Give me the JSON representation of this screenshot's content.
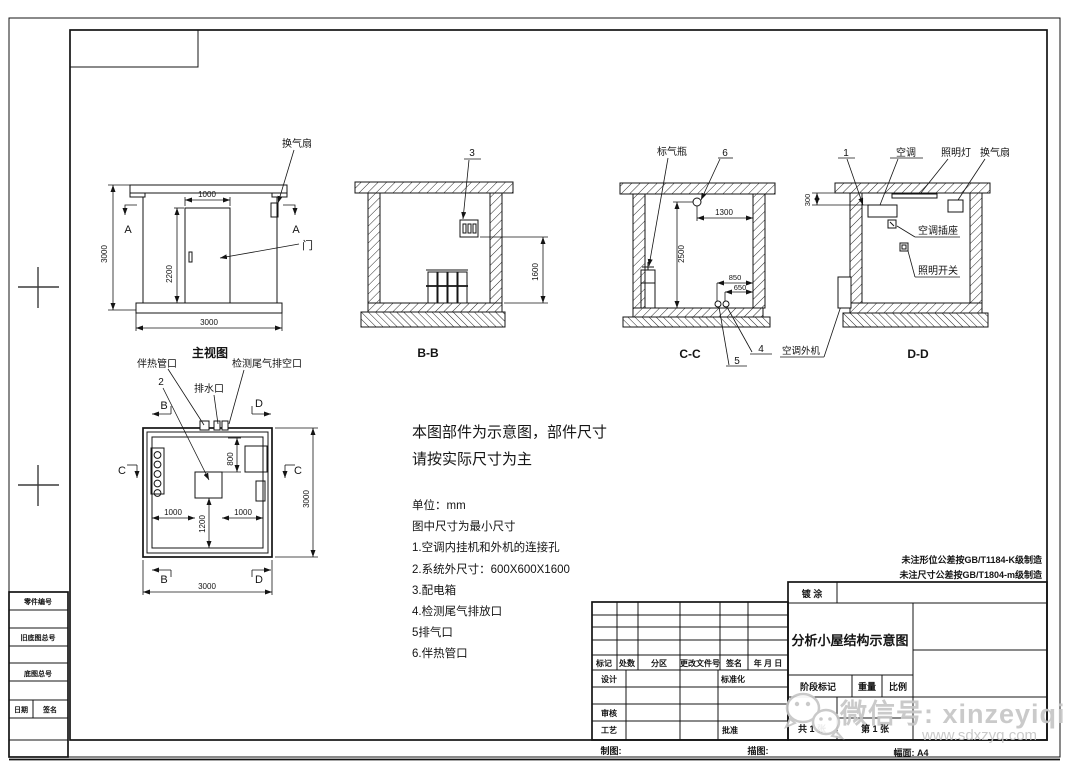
{
  "front_view": {
    "title": "主视图",
    "fan_label": "换气扇",
    "door_label": "门",
    "section_left": "A",
    "section_right": "A",
    "dim_height": "3000",
    "dim_door_width": "1000",
    "dim_door_height": "2200",
    "dim_width": "3000"
  },
  "section_bb": {
    "title": "B-B",
    "item3": "3",
    "dim_1600": "1600"
  },
  "section_cc": {
    "title": "C-C",
    "gas_bottle_label": "标气瓶",
    "item6": "6",
    "item5": "5",
    "item4": "4",
    "dim_1300": "1300",
    "dim_2500": "2500",
    "dim_850": "850",
    "dim_650": "650",
    "outdoor_unit_label": "空调外机"
  },
  "section_dd": {
    "title": "D-D",
    "item1": "1",
    "ac_label": "空调",
    "lamp_label": "照明灯",
    "fan_label": "换气扇",
    "socket_label": "空调插座",
    "switch_label": "照明开关",
    "dim_300": "300"
  },
  "plan_view": {
    "heat_pipe_label": "伴热管口",
    "item2": "2",
    "drain_label": "排水口",
    "exhaust_label": "检测尾气排空口",
    "sec_b_top": "B",
    "sec_b_bottom": "B",
    "sec_c_left": "C",
    "sec_c_right": "C",
    "sec_d_top": "D",
    "sec_d_bottom": "D",
    "dim_800": "800",
    "dim_1000_left": "1000",
    "dim_1200": "1200",
    "dim_1000_right": "1000",
    "dim_3000_right": "3000",
    "dim_3000_bottom": "3000"
  },
  "notes": {
    "headline1": "本图部件为示意图，部件尺寸",
    "headline2": "请按实际尺寸为主",
    "unit": "单位：mm",
    "min_size": "图中尺寸为最小尺寸",
    "item1": "1.空调内挂机和外机的连接孔",
    "item2": "2.系统外尺寸：600X600X1600",
    "item3": "3.配电箱",
    "item4": "4.检测尾气排放口",
    "item5": "5排气口",
    "item6": "6.伴热管口"
  },
  "tolerance_notes": {
    "line1": "未注形位公差按GB/T1184-K级制造",
    "line2": "未注尺寸公差按GB/T1804-m级制造"
  },
  "title_block": {
    "coating": "镀 涂",
    "drawing_title": "分析小屋结构示意图",
    "stage_mark": "阶段标记",
    "weight": "重量",
    "scale": "比例",
    "total_sheets": "共 1 张",
    "sheet_no": "第 1 张",
    "format": "幅面: A4",
    "draw_label": "制图:",
    "trace_label": "描图:"
  },
  "revision_table": {
    "headers": [
      "标记",
      "处数",
      "分区",
      "更改文件号",
      "签名",
      "年 月 日"
    ],
    "design": "设计",
    "standardization": "标准化",
    "review": "审核",
    "process": "工艺",
    "approve": "批准"
  },
  "side_block": {
    "part_no": "零件编号",
    "old_negative_no": "旧底图总号",
    "negative_no": "底图总号",
    "date": "日期",
    "signature": "签名"
  },
  "watermark": {
    "wechat_id": "微信号: xinzeyiqi",
    "website": "www.sdxzyq.com"
  },
  "colors": {
    "line": "#141414",
    "watermark": "#c6c6c6"
  }
}
